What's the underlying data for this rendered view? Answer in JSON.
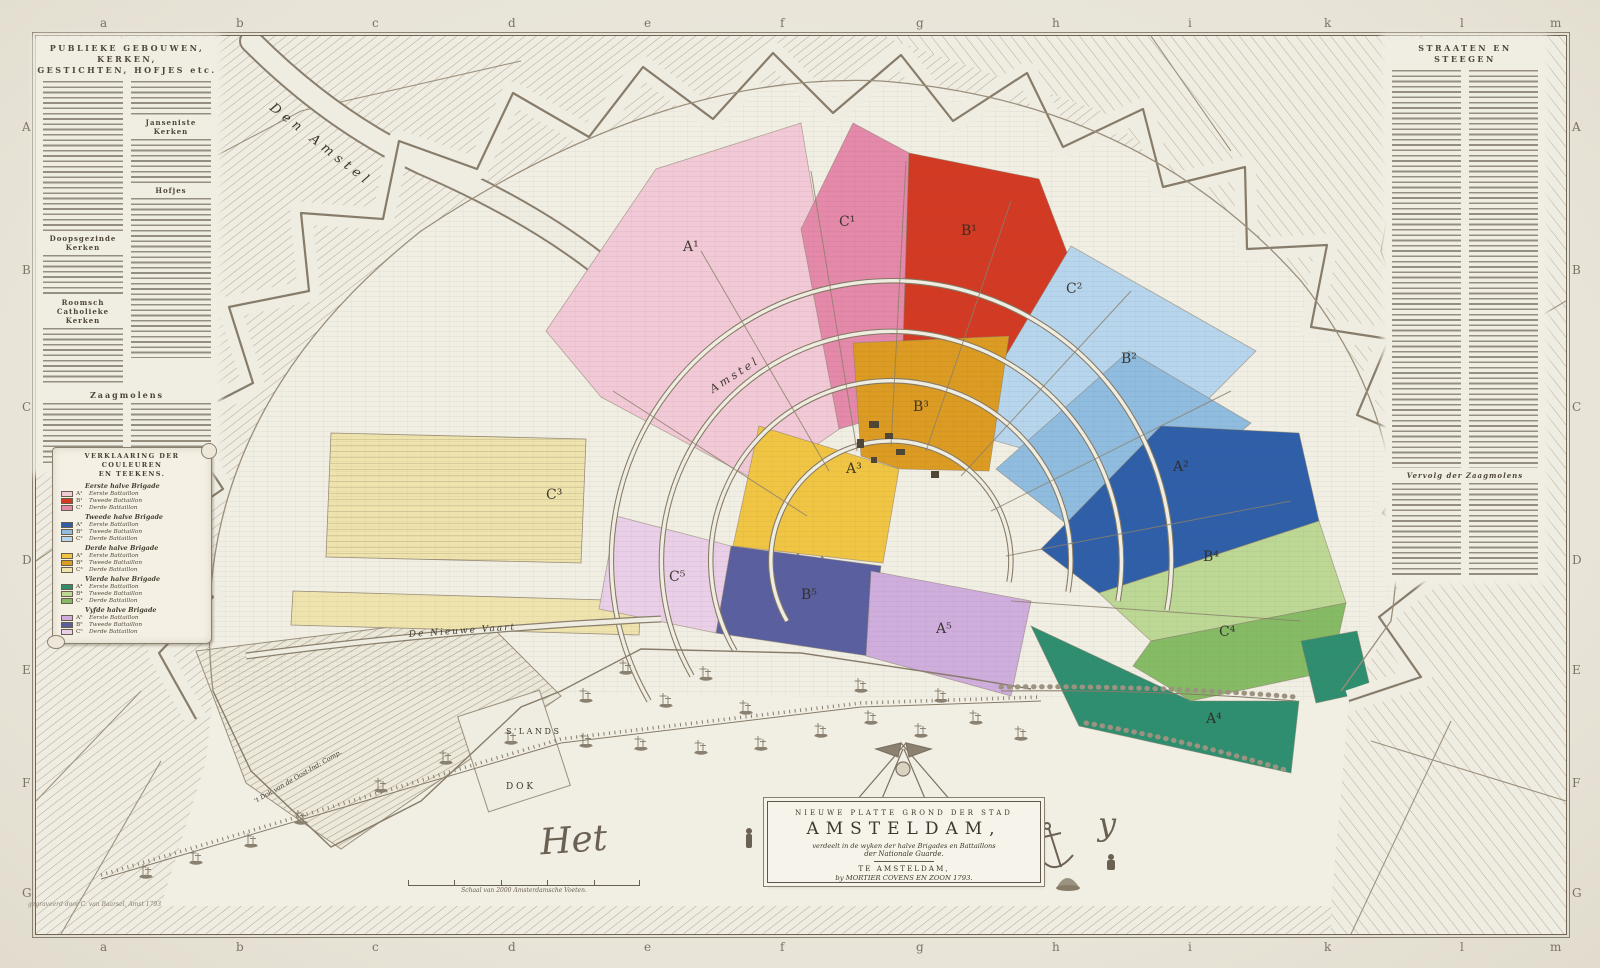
{
  "map": {
    "type": "antique-city-map",
    "city": "Amsterdam",
    "year": "1793"
  },
  "grid": {
    "top": [
      "a",
      "b",
      "c",
      "d",
      "e",
      "f",
      "g",
      "h",
      "i",
      "k",
      "l",
      "m"
    ],
    "bottom": [
      "a",
      "b",
      "c",
      "d",
      "e",
      "f",
      "g",
      "h",
      "i",
      "k",
      "l",
      "m"
    ],
    "left": [
      "A",
      "B",
      "C",
      "D",
      "E",
      "F",
      "G"
    ],
    "right": [
      "A",
      "B",
      "C",
      "D",
      "E",
      "F",
      "G"
    ]
  },
  "left_panel": {
    "title_line1": "PUBLIEKE GEBOUWEN, KERKEN,",
    "title_line2": "GESTICHTEN, HOFJES etc.",
    "sub_janseniste": "Janseniste Kerken",
    "sub_hofjes": "Hofjes",
    "sub_doopsgezinde": "Doopsgezinde Kerken",
    "sub_roomsch": "Roomsch Catholieke Kerken",
    "sub_zaagmolens": "Zaagmolens"
  },
  "right_panel": {
    "title": "STRAATEN EN STEEGEN",
    "sub_vervolg": "Vervolg der Zaagmolens"
  },
  "legend": {
    "title_line1": "VERKLAARING DER COULEUREN",
    "title_line2": "EN TEEKENS.",
    "brigades": [
      {
        "name": "Eerste halve Brigade",
        "battalions": [
          {
            "code": "A¹",
            "label": "Eerste Battaillon",
            "color": "#f2c9d6"
          },
          {
            "code": "B¹",
            "label": "Tweede Battaillon",
            "color": "#d23a24"
          },
          {
            "code": "C¹",
            "label": "Derde Battaillon",
            "color": "#e489aa"
          }
        ]
      },
      {
        "name": "Tweede halve Brigade",
        "battalions": [
          {
            "code": "A²",
            "label": "Eerste Battaillon",
            "color": "#2f5fa8"
          },
          {
            "code": "B²",
            "label": "Tweede Battaillon",
            "color": "#8fbcdf"
          },
          {
            "code": "C²",
            "label": "Derde Battaillon",
            "color": "#b7d5ec"
          }
        ]
      },
      {
        "name": "Derde halve Brigade",
        "battalions": [
          {
            "code": "A³",
            "label": "Eerste Battaillon",
            "color": "#f0c544"
          },
          {
            "code": "B³",
            "label": "Tweede Battaillon",
            "color": "#dc9b22"
          },
          {
            "code": "C³",
            "label": "Derde Battaillon",
            "color": "#efe3ae"
          }
        ]
      },
      {
        "name": "Vierde halve Brigade",
        "battalions": [
          {
            "code": "A⁴",
            "label": "Eerste Battaillon",
            "color": "#2f8e6f"
          },
          {
            "code": "B⁴",
            "label": "Tweede Battaillon",
            "color": "#bdd795"
          },
          {
            "code": "C⁴",
            "label": "Derde Battaillon",
            "color": "#86bb66"
          }
        ]
      },
      {
        "name": "Vyfde halve Brigade",
        "battalions": [
          {
            "code": "A⁵",
            "label": "Eerste Battaillon",
            "color": "#cfaede"
          },
          {
            "code": "B⁵",
            "label": "Tweede Battaillon",
            "color": "#5a5f9f"
          },
          {
            "code": "C⁵",
            "label": "Derde Battaillon",
            "color": "#e9cfe7"
          }
        ]
      }
    ]
  },
  "districts": [
    {
      "label": "A¹",
      "color": "#f2c9d6"
    },
    {
      "label": "B¹",
      "color": "#d23a24"
    },
    {
      "label": "C¹",
      "color": "#e489aa"
    },
    {
      "label": "A²",
      "color": "#2f5fa8"
    },
    {
      "label": "B²",
      "color": "#8fbcdf"
    },
    {
      "label": "C²",
      "color": "#b7d5ec"
    },
    {
      "label": "A³",
      "color": "#f0c544"
    },
    {
      "label": "B³",
      "color": "#dc9b22"
    },
    {
      "label": "C³",
      "color": "#efe3ae"
    },
    {
      "label": "A⁴",
      "color": "#2f8e6f"
    },
    {
      "label": "B⁴",
      "color": "#bdd795"
    },
    {
      "label": "C⁴",
      "color": "#86bb66"
    },
    {
      "label": "A⁵",
      "color": "#cfaede"
    },
    {
      "label": "B⁵",
      "color": "#5a5f9f"
    },
    {
      "label": "C⁵",
      "color": "#e9cfe7"
    }
  ],
  "cartouche": {
    "line1": "NIEUWE PLATTE GROND DER STAD",
    "line2": "AMSTELDAM,",
    "line3": "verdeelt in de wyken der halve Brigades en Battaillons",
    "line4": "der Nationale Guarde.",
    "line5": "TE AMSTELDAM,",
    "line6": "by MORTIER COVENS EN ZOON 1793."
  },
  "labels": {
    "den_amstel": "Den  Amstel",
    "amstel": "Amstel",
    "nieuwe_vaart": "De Nieuwe Vaart",
    "slands": "S ' L A N D S",
    "dok": "D O K",
    "oost_ind_dok": "'t Dok van de Oost-Ind: Comp.",
    "het": "Het",
    "y": "y",
    "scale_caption": "Schaal van 2000 Amsterdamsche Voeten.",
    "engraver": "gegraveerd door C. van Baarsel, Amst 1793"
  },
  "colors": {
    "paper": "#efece2",
    "paper_outer": "#e8e4d8",
    "engraving_line": "#877c69",
    "hatch": "#b2a894",
    "text_dark": "#473f31"
  }
}
